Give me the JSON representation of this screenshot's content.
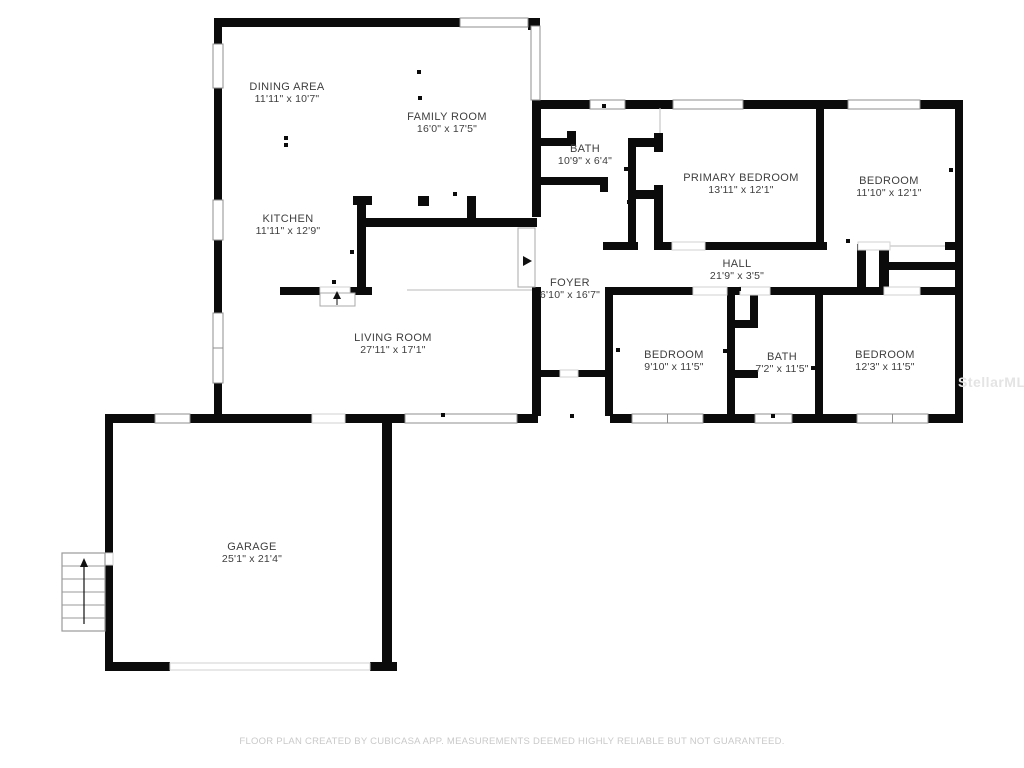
{
  "footer": {
    "text": "FLOOR PLAN CREATED BY CUBICASA APP. MEASUREMENTS DEEMED HIGHLY RELIABLE BUT NOT GUARANTEED."
  },
  "watermark": {
    "text": "StellarMLS"
  },
  "colors": {
    "wall": "#0b0b0b",
    "window_edge": "#8f8f8f",
    "gap_edge": "#d2d2d2",
    "thin_line": "#c6c6c6",
    "label": "#3e3e3e",
    "stairs_edge": "#9a9a9a"
  },
  "rooms": [
    {
      "id": "dining-area",
      "name": "DINING AREA",
      "dims": "11'11\" x 10'7\"",
      "cx": 287,
      "y1": 90,
      "y2": 102
    },
    {
      "id": "family-room",
      "name": "FAMILY ROOM",
      "dims": "16'0\" x 17'5\"",
      "cx": 447,
      "y1": 120,
      "y2": 132
    },
    {
      "id": "kitchen",
      "name": "KITCHEN",
      "dims": "11'11\" x 12'9\"",
      "cx": 288,
      "y1": 222,
      "y2": 234
    },
    {
      "id": "bath-upper",
      "name": "BATH",
      "dims": "10'9\" x 6'4\"",
      "cx": 585,
      "y1": 152,
      "y2": 164
    },
    {
      "id": "primary-bedroom",
      "name": "PRIMARY BEDROOM",
      "dims": "13'11\" x 12'1\"",
      "cx": 741,
      "y1": 181,
      "y2": 193
    },
    {
      "id": "bedroom-ne",
      "name": "BEDROOM",
      "dims": "11'10\" x 12'1\"",
      "cx": 889,
      "y1": 184,
      "y2": 196
    },
    {
      "id": "hall",
      "name": "HALL",
      "dims": "21'9\" x 3'5\"",
      "cx": 737,
      "y1": 267,
      "y2": 279
    },
    {
      "id": "foyer",
      "name": "FOYER",
      "dims": "6'10\" x 16'7\"",
      "cx": 570,
      "y1": 286,
      "y2": 298
    },
    {
      "id": "living-room",
      "name": "LIVING ROOM",
      "dims": "27'11\" x 17'1\"",
      "cx": 393,
      "y1": 341,
      "y2": 353
    },
    {
      "id": "bedroom-s1",
      "name": "BEDROOM",
      "dims": "9'10\" x 11'5\"",
      "cx": 674,
      "y1": 358,
      "y2": 370
    },
    {
      "id": "bath-lower",
      "name": "BATH",
      "dims": "7'2\" x 11'5\"",
      "cx": 782,
      "y1": 360,
      "y2": 372
    },
    {
      "id": "bedroom-se",
      "name": "BEDROOM",
      "dims": "12'3\" x 11'5\"",
      "cx": 885,
      "y1": 358,
      "y2": 370
    },
    {
      "id": "garage",
      "name": "GARAGE",
      "dims": "25'1\" x 21'4\"",
      "cx": 252,
      "y1": 550,
      "y2": 562
    }
  ],
  "walls": [
    [
      214,
      18,
      8,
      26
    ],
    [
      214,
      88,
      8,
      112
    ],
    [
      214,
      240,
      8,
      73
    ],
    [
      214,
      383,
      8,
      33
    ],
    [
      214,
      18,
      246,
      9
    ],
    [
      528,
      18,
      12,
      12
    ],
    [
      532,
      100,
      9,
      117
    ],
    [
      532,
      287,
      9,
      129
    ],
    [
      605,
      287,
      8,
      129
    ],
    [
      362,
      218,
      175,
      9
    ],
    [
      357,
      196,
      9,
      98
    ],
    [
      353,
      196,
      19,
      9
    ],
    [
      418,
      196,
      11,
      10
    ],
    [
      467,
      196,
      9,
      24
    ],
    [
      280,
      287,
      40,
      8
    ],
    [
      350,
      287,
      22,
      8
    ],
    [
      541,
      370,
      19,
      7
    ],
    [
      578,
      370,
      27,
      7
    ],
    [
      105,
      414,
      50,
      9
    ],
    [
      190,
      414,
      122,
      9
    ],
    [
      345,
      414,
      60,
      9
    ],
    [
      517,
      414,
      21,
      9
    ],
    [
      610,
      414,
      22,
      9
    ],
    [
      703,
      414,
      52,
      9
    ],
    [
      792,
      414,
      65,
      9
    ],
    [
      928,
      414,
      35,
      9
    ],
    [
      105,
      414,
      8,
      139
    ],
    [
      105,
      565,
      8,
      106
    ],
    [
      105,
      662,
      65,
      9
    ],
    [
      370,
      662,
      27,
      9
    ],
    [
      382,
      414,
      10,
      257
    ],
    [
      532,
      100,
      58,
      9
    ],
    [
      625,
      100,
      48,
      9
    ],
    [
      743,
      100,
      105,
      9
    ],
    [
      920,
      100,
      43,
      9
    ],
    [
      955,
      100,
      8,
      323
    ],
    [
      532,
      177,
      76,
      8
    ],
    [
      600,
      185,
      8,
      7
    ],
    [
      540,
      138,
      36,
      8
    ],
    [
      567,
      131,
      9,
      15
    ],
    [
      628,
      138,
      8,
      112
    ],
    [
      628,
      138,
      34,
      9
    ],
    [
      628,
      190,
      34,
      9
    ],
    [
      654,
      185,
      9,
      62
    ],
    [
      654,
      133,
      9,
      19
    ],
    [
      816,
      108,
      8,
      142
    ],
    [
      603,
      242,
      35,
      8
    ],
    [
      654,
      242,
      18,
      8
    ],
    [
      705,
      242,
      122,
      8
    ],
    [
      945,
      242,
      18,
      8
    ],
    [
      857,
      244,
      9,
      48
    ],
    [
      879,
      244,
      10,
      48
    ],
    [
      888,
      262,
      67,
      8
    ],
    [
      613,
      287,
      80,
      8
    ],
    [
      727,
      287,
      13,
      8
    ],
    [
      770,
      287,
      114,
      8
    ],
    [
      920,
      287,
      43,
      8
    ],
    [
      727,
      287,
      8,
      127
    ],
    [
      815,
      287,
      8,
      127
    ],
    [
      750,
      295,
      8,
      30
    ],
    [
      728,
      320,
      30,
      8
    ],
    [
      728,
      370,
      30,
      8
    ]
  ],
  "windows": [
    {
      "r": [
        213,
        44,
        10,
        44
      ],
      "o": "v",
      "kind": "window",
      "mid": false
    },
    {
      "r": [
        213,
        200,
        10,
        40
      ],
      "o": "v",
      "kind": "window",
      "mid": false
    },
    {
      "r": [
        213,
        313,
        10,
        70
      ],
      "o": "v",
      "kind": "window",
      "mid": true
    },
    {
      "r": [
        460,
        18,
        68,
        9
      ],
      "o": "h",
      "kind": "window",
      "mid": false
    },
    {
      "r": [
        531,
        26,
        9,
        74
      ],
      "o": "v",
      "kind": "window",
      "mid": false
    },
    {
      "r": [
        590,
        100,
        35,
        9
      ],
      "o": "h",
      "kind": "window",
      "mid": false
    },
    {
      "r": [
        673,
        100,
        70,
        9
      ],
      "o": "h",
      "kind": "window",
      "mid": false
    },
    {
      "r": [
        848,
        100,
        72,
        9
      ],
      "o": "h",
      "kind": "window",
      "mid": false
    },
    {
      "r": [
        155,
        414,
        35,
        9
      ],
      "o": "h",
      "kind": "window",
      "mid": false
    },
    {
      "r": [
        405,
        414,
        112,
        9
      ],
      "o": "h",
      "kind": "window",
      "mid": false
    },
    {
      "r": [
        632,
        414,
        71,
        9
      ],
      "o": "h",
      "kind": "window",
      "mid": true
    },
    {
      "r": [
        755,
        414,
        37,
        9
      ],
      "o": "h",
      "kind": "window",
      "mid": false
    },
    {
      "r": [
        857,
        414,
        71,
        9
      ],
      "o": "h",
      "kind": "window",
      "mid": true
    },
    {
      "r": [
        312,
        414,
        33,
        9
      ],
      "o": "h",
      "kind": "gap",
      "mid": false
    },
    {
      "r": [
        170,
        663,
        200,
        7
      ],
      "o": "h",
      "kind": "gap",
      "mid": false
    },
    {
      "r": [
        672,
        242,
        33,
        8
      ],
      "o": "h",
      "kind": "gap",
      "mid": false
    },
    {
      "r": [
        858,
        242,
        32,
        8
      ],
      "o": "h",
      "kind": "gap",
      "mid": false
    },
    {
      "r": [
        560,
        370,
        18,
        7
      ],
      "o": "h",
      "kind": "gap",
      "mid": false
    },
    {
      "r": [
        693,
        287,
        34,
        8
      ],
      "o": "h",
      "kind": "gap",
      "mid": false
    },
    {
      "r": [
        740,
        287,
        30,
        8
      ],
      "o": "h",
      "kind": "gap",
      "mid": false
    },
    {
      "r": [
        884,
        287,
        36,
        8
      ],
      "o": "h",
      "kind": "gap",
      "mid": false
    },
    {
      "r": [
        105,
        553,
        8,
        12
      ],
      "o": "v",
      "kind": "gap",
      "mid": false
    },
    {
      "r": [
        320,
        287,
        30,
        8
      ],
      "o": "h",
      "kind": "gap",
      "mid": false
    }
  ],
  "thin_lines": [
    [
      407,
      290,
      532,
      290
    ],
    [
      660,
      108,
      660,
      133
    ],
    [
      858,
      246,
      945,
      246
    ]
  ],
  "door_panels": [
    [
      518,
      228,
      17,
      59
    ],
    [
      320,
      293,
      35,
      13
    ]
  ],
  "door_arrows": [
    {
      "points": "523,256 523,266 532,261",
      "stem": null
    },
    {
      "points": "337,291 333,299 341,299",
      "stem": [
        337,
        299,
        337,
        305
      ]
    }
  ],
  "ticks": [
    [
      283,
      20
    ],
    [
      419,
      72
    ],
    [
      420,
      98
    ],
    [
      286,
      138
    ],
    [
      286,
      145
    ],
    [
      455,
      194
    ],
    [
      334,
      282
    ],
    [
      352,
      252
    ],
    [
      604,
      106
    ],
    [
      626,
      169
    ],
    [
      820,
      171
    ],
    [
      951,
      170
    ],
    [
      629,
      202
    ],
    [
      739,
      289
    ],
    [
      773,
      416
    ],
    [
      846,
      416
    ],
    [
      251,
      420
    ],
    [
      572,
      416
    ],
    [
      618,
      350
    ],
    [
      725,
      351
    ],
    [
      813,
      368
    ],
    [
      953,
      267
    ],
    [
      443,
      415
    ],
    [
      848,
      241
    ]
  ],
  "stairs": {
    "box": [
      62,
      553,
      43,
      78
    ],
    "treads_y": [
      566,
      579,
      592,
      605,
      618
    ],
    "arrow_stem": [
      84,
      566,
      84,
      624
    ],
    "arrow_head": "84,558 80,567 88,567"
  }
}
